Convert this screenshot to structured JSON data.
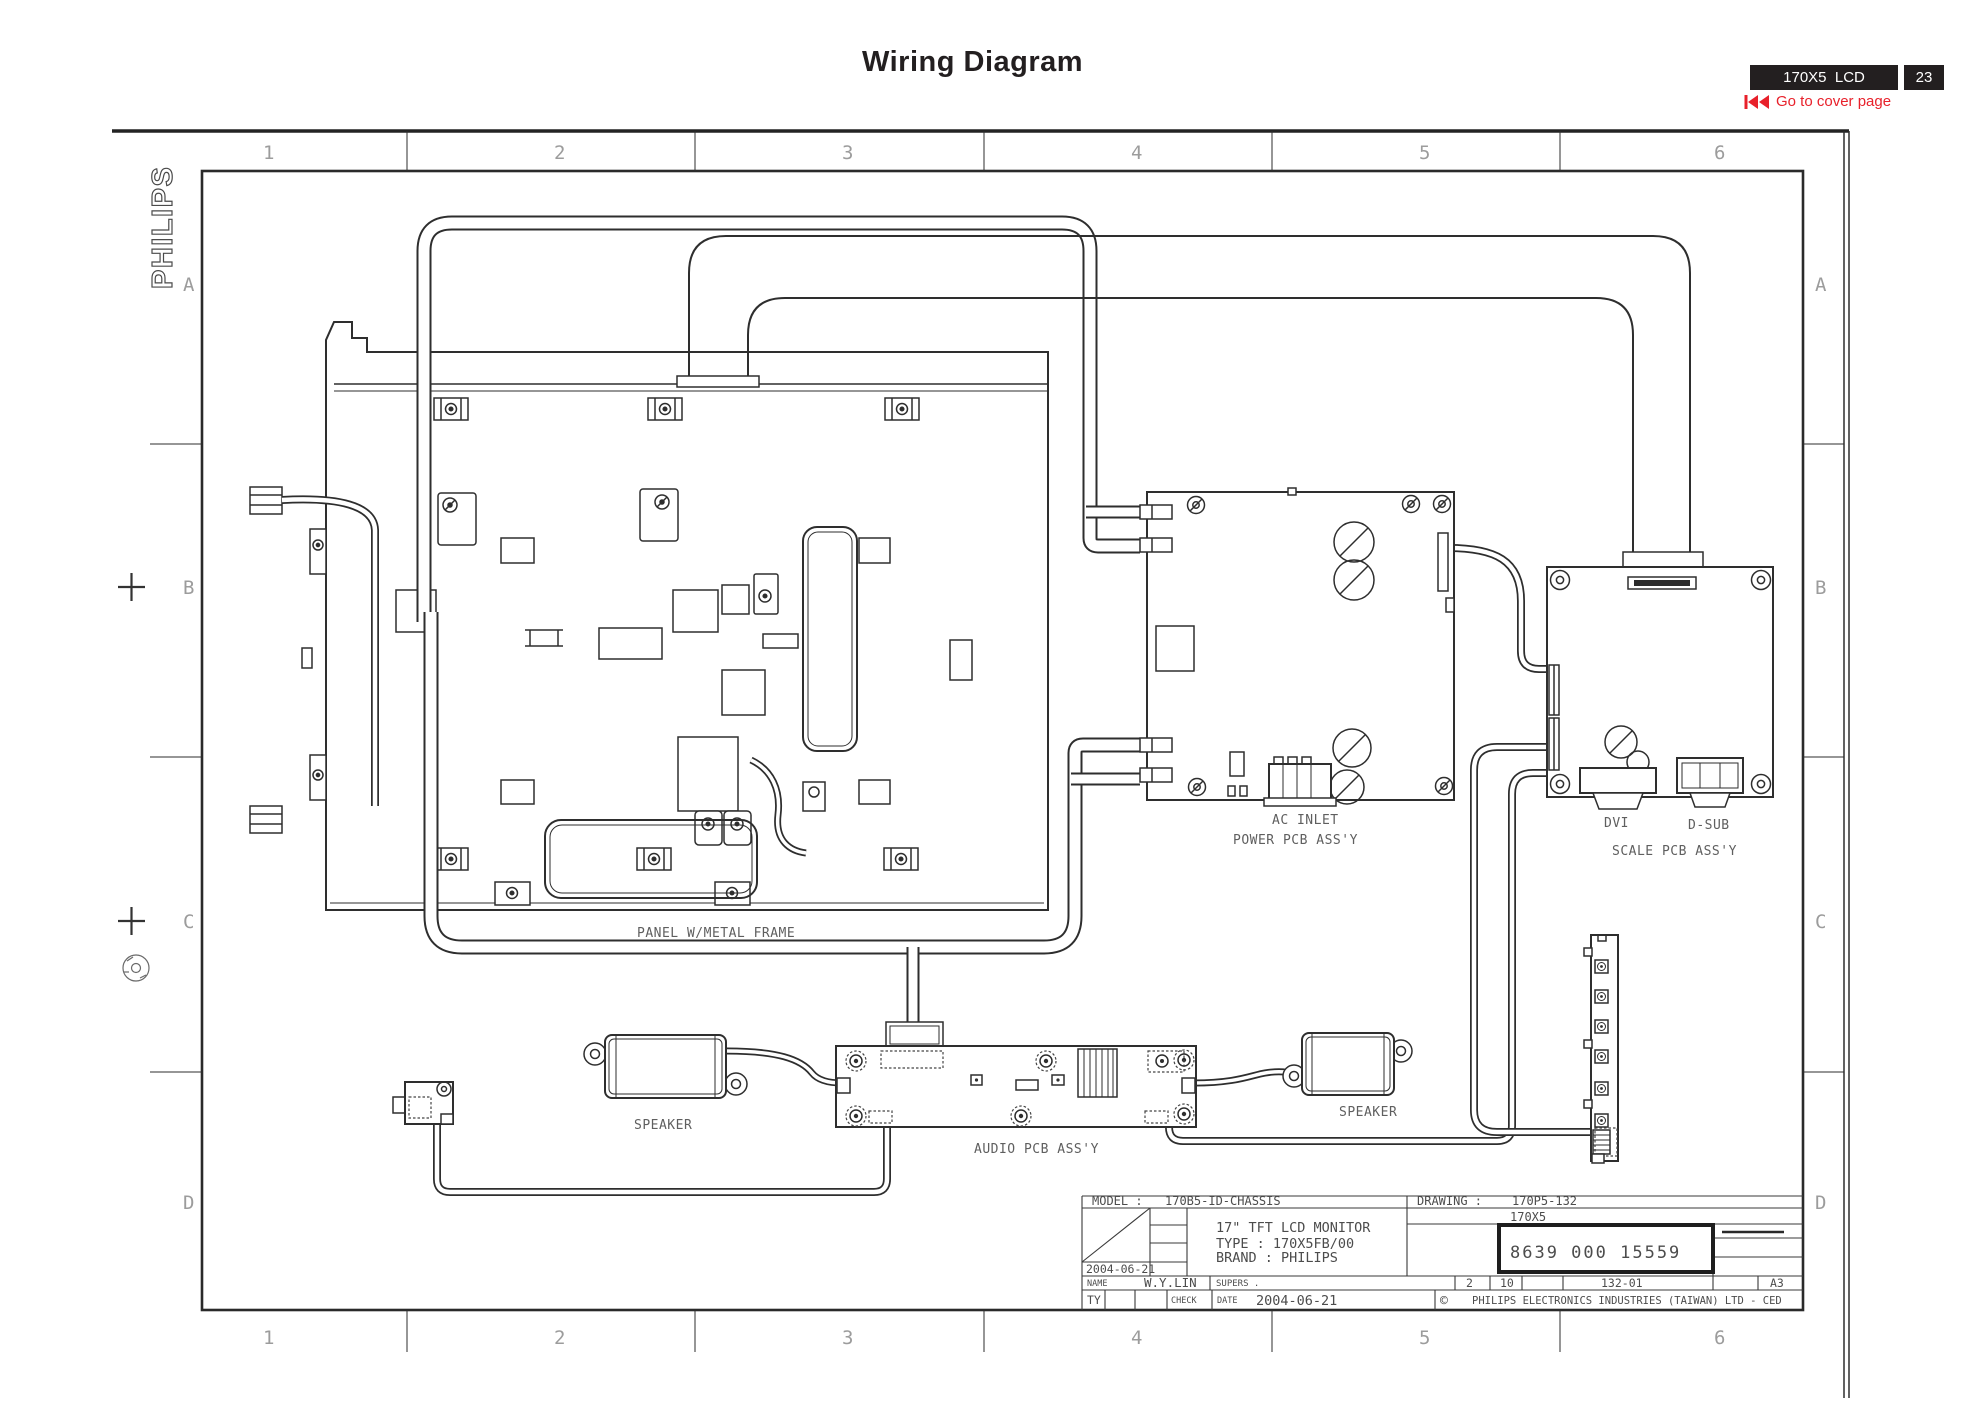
{
  "header": {
    "title": "Wiring Diagram",
    "model_badge": "170X5  LCD",
    "page_badge": "23",
    "back_link": "Go to cover page"
  },
  "frame": {
    "brand": "PHILIPS",
    "columns": [
      "1",
      "2",
      "3",
      "4",
      "5",
      "6"
    ],
    "rows": [
      "A",
      "B",
      "C",
      "D"
    ]
  },
  "labels": {
    "panel": "PANEL W/METAL FRAME",
    "ac_inlet": "AC INLET",
    "power_pcb": "POWER PCB ASS'Y",
    "dvi": "DVI",
    "dsub": "D-SUB",
    "scale_pcb": "SCALE PCB ASS'Y",
    "speaker_left": "SPEAKER",
    "speaker_right": "SPEAKER",
    "audio_pcb": "AUDIO PCB ASS'Y"
  },
  "title_block": {
    "model_label": "MODEL :",
    "model_value": "170B5-ID-CHASSIS",
    "drawing_label": "DRAWING :",
    "drawing_value": "170P5-132",
    "product": "170X5",
    "desc_line1": "17\" TFT LCD MONITOR",
    "desc_line2": "TYPE : 170X5FB/00",
    "desc_line3": "BRAND : PHILIPS",
    "date_small": "2004-06-21",
    "part_number": "8639 000 15559",
    "name_label": "NAME",
    "name_value": "W.Y.LIN",
    "supers_label": "SUPERS .",
    "sheet_number": "2",
    "sheet_total": "10",
    "revision": "132-01",
    "paper_size": "A3",
    "ty_label": "TY",
    "check_label": "CHECK",
    "date_label": "DATE",
    "date_value": "2004-06-21",
    "copyright": "©",
    "company": "PHILIPS ELECTRONICS INDUSTRIES (TAIWAN) LTD - CED"
  }
}
